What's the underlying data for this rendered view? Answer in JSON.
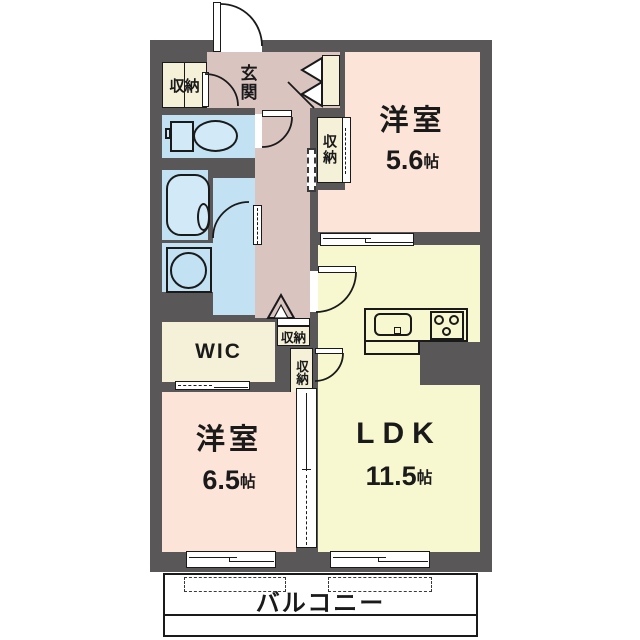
{
  "rooms": {
    "bedroom1": {
      "label": "洋室",
      "area": "5.6",
      "unit": "帖"
    },
    "bedroom2": {
      "label": "洋室",
      "area": "6.5",
      "unit": "帖"
    },
    "ldk": {
      "label": "LDK",
      "area": "11.5",
      "unit": "帖"
    },
    "wic": {
      "label": "WIC"
    },
    "entrance": {
      "label": "玄関"
    },
    "balcony": {
      "label": "バルコニー"
    }
  },
  "storage": {
    "entrance_closet": "収納",
    "bedroom1_closet": "収納",
    "hall_storage": "収納",
    "ldk_storage": "収納"
  },
  "colors": {
    "wall": "#595757",
    "hall_floor": "#d9c4bf",
    "bedroom_floor": "#fce4d8",
    "ldk_floor": "#f8f8d0",
    "wet_area": "#c2e2f4",
    "closet": "#f5f0d8",
    "balcony": "#ffffff"
  }
}
